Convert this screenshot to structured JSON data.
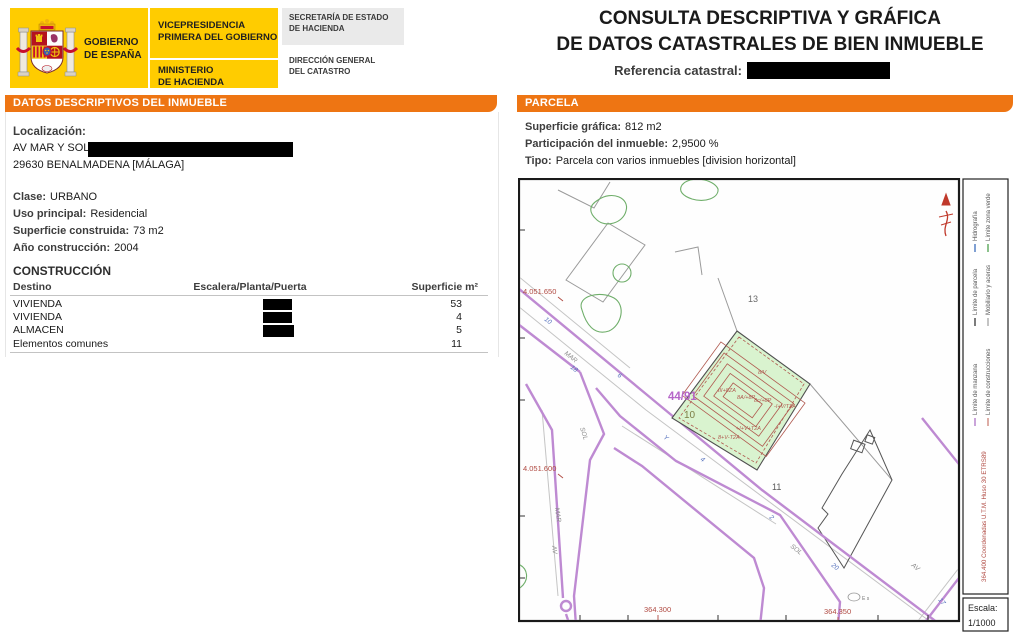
{
  "header": {
    "gobierno": "GOBIERNO\nDE ESPAÑA",
    "vicepresidencia": "VICEPRESIDENCIA\nPRIMERA DEL GOBIERNO",
    "ministerio": "MINISTERIO\nDE HACIENDA",
    "secretaria": "SECRETARÍA DE ESTADO\nDE HACIENDA",
    "direccion": "DIRECCIÓN GENERAL\nDEL CATASTRO"
  },
  "title": {
    "line1": "CONSULTA DESCRIPTIVA Y GRÁFICA",
    "line2": "DE DATOS CATASTRALES DE BIEN INMUEBLE",
    "ref_label": "Referencia catastral:"
  },
  "left_panel": {
    "header": "DATOS DESCRIPTIVOS DEL INMUEBLE",
    "localizacion_label": "Localización:",
    "address_line1": "AV MAR Y SOL",
    "address_line2": "29630 BENALMADENA [MÁLAGA]",
    "fields": [
      {
        "label": "Clase:",
        "value": "URBANO"
      },
      {
        "label": "Uso principal:",
        "value": "Residencial"
      },
      {
        "label": "Superficie construida:",
        "value": "73 m2"
      },
      {
        "label": "Año construcción:",
        "value": "2004"
      }
    ],
    "construccion_title": "CONSTRUCCIÓN",
    "table": {
      "headers": [
        "Destino",
        "Escalera/Planta/Puerta",
        "Superficie m²"
      ],
      "rows": [
        {
          "destino": "VIVIENDA",
          "superficie": "53"
        },
        {
          "destino": "VIVIENDA",
          "superficie": "4"
        },
        {
          "destino": "ALMACEN",
          "superficie": "5"
        },
        {
          "destino": "Elementos comunes",
          "superficie": "11"
        }
      ]
    }
  },
  "right_panel": {
    "header": "PARCELA",
    "fields": [
      {
        "label": "Superficie gráfica:",
        "value": "812 m2"
      },
      {
        "label": "Participación del inmueble:",
        "value": "2,9500 %"
      },
      {
        "label": "Tipo:",
        "value": "Parcela con varios inmuebles [division horizontal]"
      }
    ],
    "map": {
      "coords_left": [
        "4.051.650",
        "4.051.600"
      ],
      "coords_bottom": [
        "364.300",
        "364.350"
      ],
      "coords_right_vertical": "364.400 Coordenadas U.T.M. Huso 30 ETRS89",
      "parcel_number_13": "13",
      "parcel_number_10": "10",
      "parcel_number_11": "11",
      "parcel_ref": "44/91",
      "streets": {
        "mar_upper": "MAR",
        "sol_upper": "SOL",
        "mar_lower": "MAR",
        "av_lower": "AV",
        "sol_right": "SOL",
        "av_right": "AV"
      },
      "numbers": [
        "10",
        "18",
        "6",
        "Y",
        "4",
        "2",
        "20",
        "17"
      ],
      "construction_labels": [
        "8/V",
        "III+8ZA",
        "8A/+8P",
        "8c/+8P",
        "-I+V/T2A",
        "+I+V+T2A",
        "8+V-T2A"
      ],
      "poi": "E s",
      "legend": [
        {
          "label": "Límite de manzana",
          "color": "#b37cc9"
        },
        {
          "label": "Límite de construcciones",
          "color": "#cf8a80"
        },
        {
          "label": "Límite de parcela",
          "color": "#444444"
        },
        {
          "label": "Mobiliario y aceras",
          "color": "#aaaaaa"
        },
        {
          "label": "Hidrografía",
          "color": "#4a78c0"
        },
        {
          "label": "Límite zona verde",
          "color": "#5aa85a"
        }
      ],
      "escala_label": "Escala:",
      "escala_value": "1/1000"
    }
  },
  "colors": {
    "accent_orange": "#EE7513",
    "gov_yellow": "#FFCC00",
    "redaction": "#000000"
  }
}
